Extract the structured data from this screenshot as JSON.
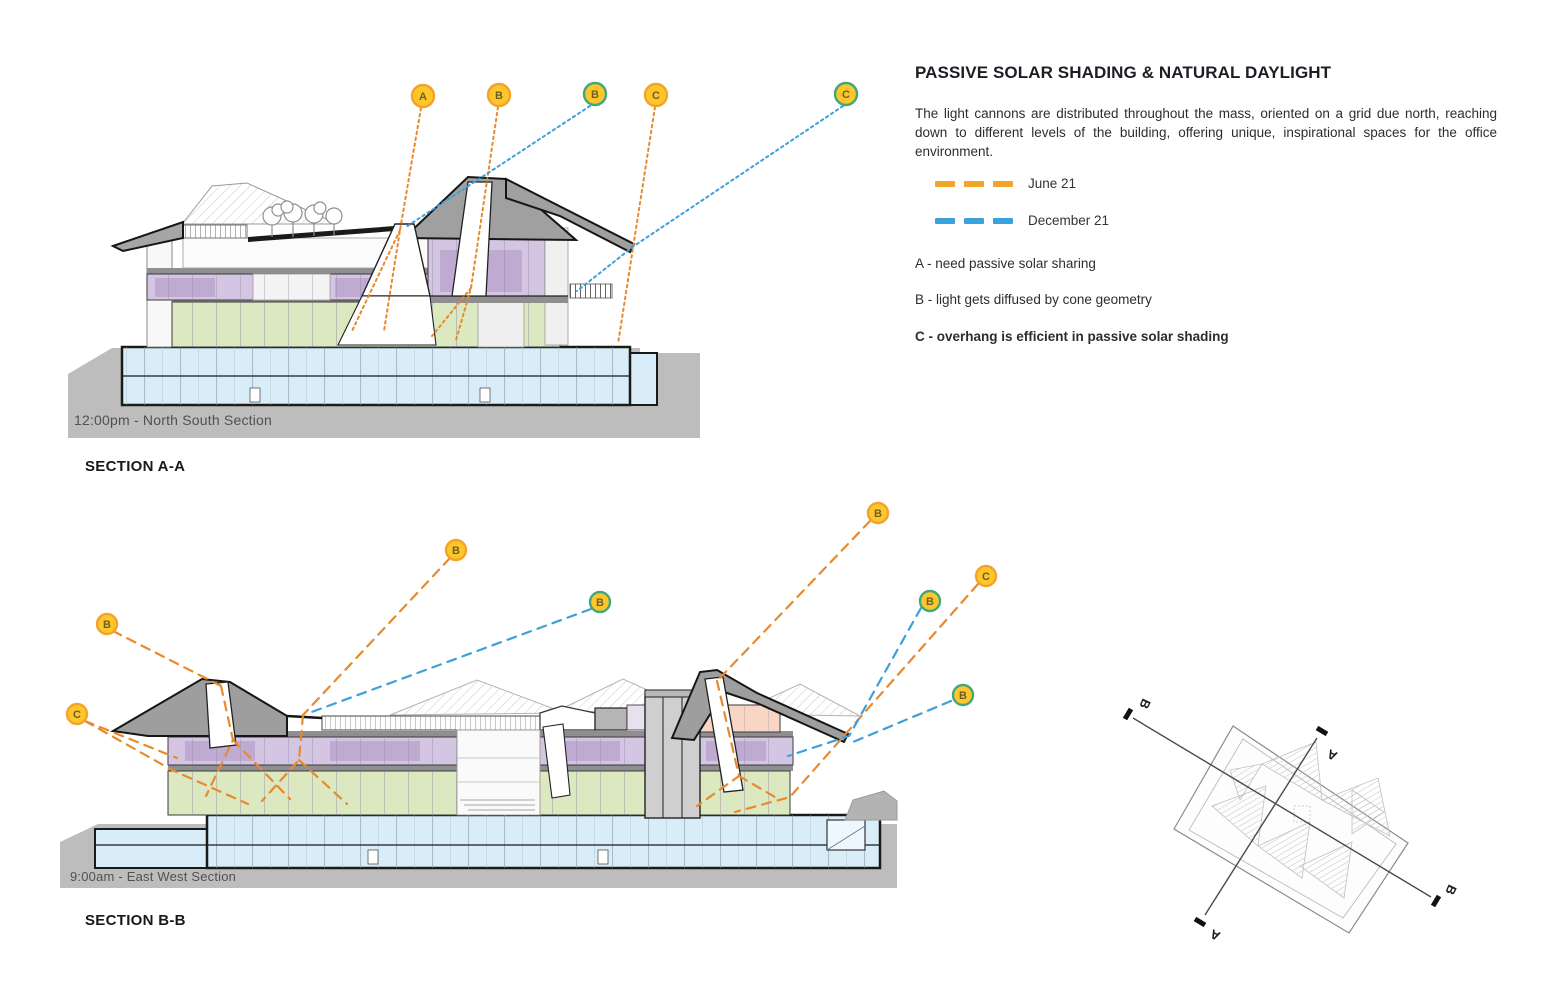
{
  "panel": {
    "title": "PASSIVE SOLAR SHADING & NATURAL DAYLIGHT",
    "paragraph": "The light cannons are distributed throughout the mass, oriented on a grid due north, reaching down to different levels of the building, offering unique, inspirational spaces for the office environment.",
    "legend": [
      {
        "label": "June 21",
        "swatch": "legend_orange"
      },
      {
        "label": "December 21",
        "swatch": "legend_blue"
      }
    ],
    "notes": [
      {
        "id": "A",
        "text": "A - need passive solar sharing"
      },
      {
        "id": "B",
        "text": "B - light gets diffused by cone geometry"
      },
      {
        "id": "C",
        "text": "C - overhang is efficient in passive solar shading"
      }
    ]
  },
  "sections": [
    {
      "id": "section-aa",
      "caption": "12:00pm - North South Section",
      "label": "SECTION A-A",
      "dash": "2.5 3.5",
      "stroke_width": 2,
      "marker_r": 11,
      "markers": [
        {
          "label": "A",
          "x": 423,
          "y": 96,
          "ring": "orange"
        },
        {
          "label": "B",
          "x": 499,
          "y": 95,
          "ring": "orange"
        },
        {
          "label": "B",
          "x": 595,
          "y": 94,
          "ring": "teal"
        },
        {
          "label": "C",
          "x": 656,
          "y": 95,
          "ring": "orange"
        },
        {
          "label": "C",
          "x": 846,
          "y": 94,
          "ring": "teal"
        }
      ],
      "leaders": [
        {
          "color": "orange",
          "points": [
            [
              421,
              108
            ],
            [
              400,
              230
            ],
            [
              384,
              331
            ]
          ]
        },
        {
          "color": "orange",
          "points": [
            [
              498,
              107
            ],
            [
              471,
              288
            ],
            [
              456,
              340
            ]
          ]
        },
        {
          "color": "orange",
          "points": [
            [
              655,
              107
            ],
            [
              618,
              344
            ]
          ]
        },
        {
          "color": "orange",
          "points": [
            [
              400,
              230
            ],
            [
              352,
              331
            ]
          ]
        },
        {
          "color": "orange",
          "points": [
            [
              471,
              288
            ],
            [
              432,
              336
            ]
          ]
        },
        {
          "color": "blue",
          "points": [
            [
              590,
              106
            ],
            [
              406,
              227
            ]
          ]
        },
        {
          "color": "blue",
          "points": [
            [
              843,
              106
            ],
            [
              634,
              246
            ],
            [
              577,
              291
            ]
          ]
        }
      ]
    },
    {
      "id": "section-bb",
      "caption": "9:00am - East West Section",
      "label": "SECTION B-B",
      "dash": "9 7",
      "stroke_width": 2.2,
      "marker_r": 10,
      "markers": [
        {
          "label": "B",
          "x": 107,
          "y": 624,
          "ring": "orange"
        },
        {
          "label": "C",
          "x": 77,
          "y": 714,
          "ring": "orange"
        },
        {
          "label": "B",
          "x": 456,
          "y": 550,
          "ring": "orange"
        },
        {
          "label": "B",
          "x": 600,
          "y": 602,
          "ring": "teal"
        },
        {
          "label": "B",
          "x": 878,
          "y": 513,
          "ring": "orange"
        },
        {
          "label": "B",
          "x": 930,
          "y": 601,
          "ring": "teal"
        },
        {
          "label": "C",
          "x": 986,
          "y": 576,
          "ring": "orange"
        },
        {
          "label": "B",
          "x": 963,
          "y": 695,
          "ring": "teal"
        }
      ],
      "leaders": [
        {
          "color": "orange",
          "points": [
            [
              113,
              631
            ],
            [
              221,
              686
            ]
          ]
        },
        {
          "color": "orange",
          "points": [
            [
              221,
              686
            ],
            [
              233,
              740
            ],
            [
              206,
              796
            ]
          ]
        },
        {
          "color": "orange",
          "points": [
            [
              233,
              740
            ],
            [
              290,
              799
            ]
          ]
        },
        {
          "color": "orange",
          "points": [
            [
              85,
              721
            ],
            [
              177,
              758
            ]
          ]
        },
        {
          "color": "orange",
          "points": [
            [
              85,
              721
            ],
            [
              172,
              770
            ],
            [
              248,
              804
            ]
          ]
        },
        {
          "color": "orange",
          "points": [
            [
              450,
              558
            ],
            [
              303,
              715
            ]
          ]
        },
        {
          "color": "orange",
          "points": [
            [
              303,
              715
            ],
            [
              299,
              760
            ],
            [
              262,
              801
            ]
          ]
        },
        {
          "color": "orange",
          "points": [
            [
              299,
              760
            ],
            [
              347,
              804
            ]
          ]
        },
        {
          "color": "orange",
          "points": [
            [
              870,
              521
            ],
            [
              717,
              681
            ]
          ]
        },
        {
          "color": "orange",
          "points": [
            [
              717,
              681
            ],
            [
              739,
              776
            ],
            [
              697,
              806
            ]
          ]
        },
        {
          "color": "orange",
          "points": [
            [
              739,
              776
            ],
            [
              780,
              800
            ]
          ]
        },
        {
          "color": "orange",
          "points": [
            [
              978,
              584
            ],
            [
              790,
              797
            ],
            [
              735,
              812
            ]
          ]
        },
        {
          "color": "blue",
          "points": [
            [
              591,
              609
            ],
            [
              309,
              713
            ]
          ]
        },
        {
          "color": "blue",
          "points": [
            [
              921,
              608
            ],
            [
              849,
              736
            ],
            [
              788,
              756
            ]
          ]
        },
        {
          "color": "blue",
          "points": [
            [
              951,
              701
            ],
            [
              853,
              742
            ]
          ]
        }
      ]
    }
  ],
  "keyplan": {
    "labels": [
      {
        "text": "B",
        "x": 1141,
        "y": 702,
        "rot": 115
      },
      {
        "text": "B",
        "x": 1447,
        "y": 888,
        "rot": 115
      },
      {
        "text": "A",
        "x": 1334,
        "y": 751,
        "rot": 205
      },
      {
        "text": "A",
        "x": 1217,
        "y": 931,
        "rot": 205
      }
    ]
  },
  "colors": {
    "orange": "#E IGNORED",
    "legend_orange": "#F2A32C",
    "legend_blue": "#3BA3DC",
    "teal": "#3FA878",
    "marker_fill": "#FFC62B",
    "marker_text": "#6A5F28",
    "floor_purple": "#D4C6E2",
    "floor_green": "#DCE9C0",
    "floor_blue": "#D8EDF8",
    "floor_peach": "#F8D6C3",
    "roof_gray": "#9E9E9E",
    "ground_gray": "#BDBDBD"
  }
}
